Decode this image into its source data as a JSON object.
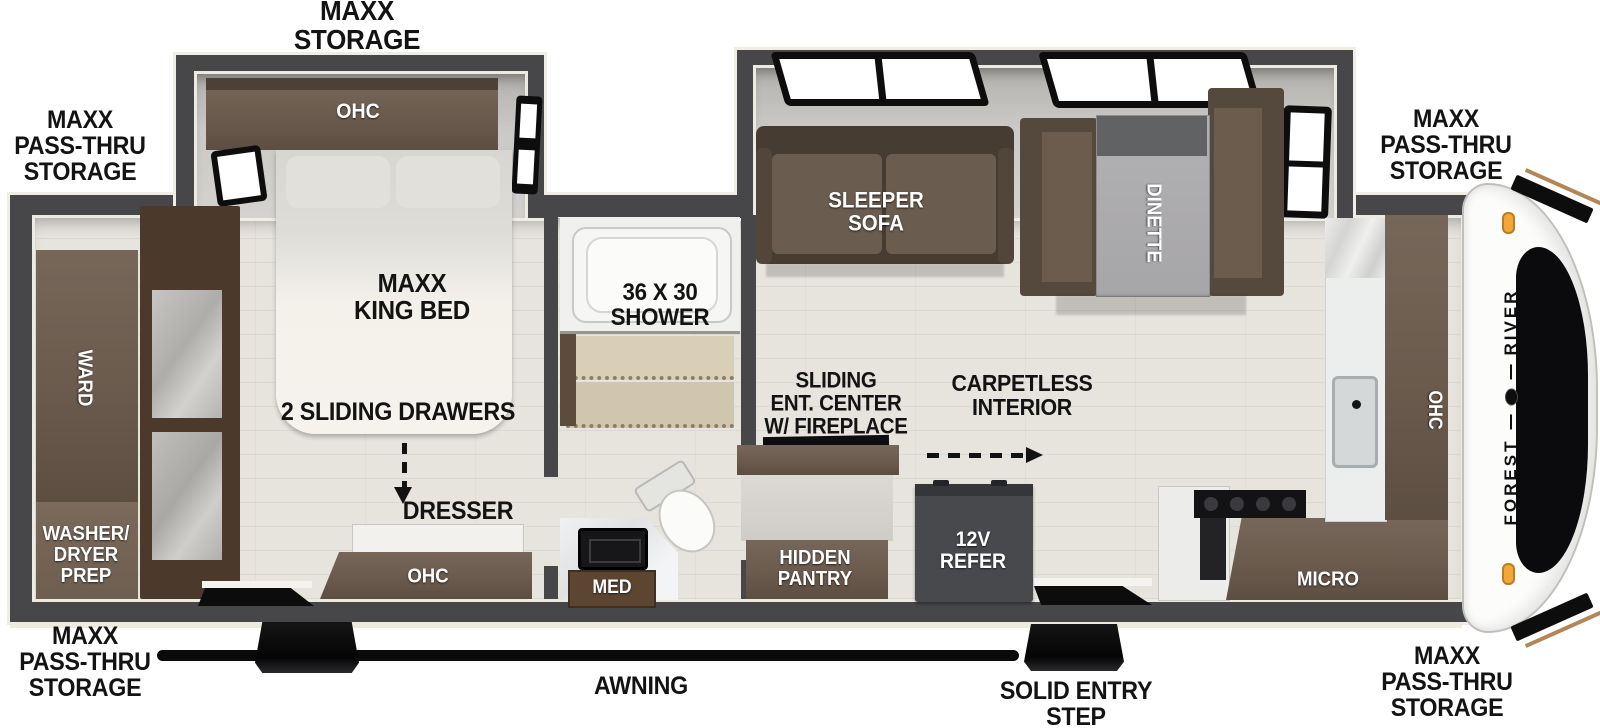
{
  "colors": {
    "wall": "#47474a",
    "trim": "#edeae2",
    "floor": "#e7e4de",
    "cabinet_brown": "#6b5b4e",
    "sofa_brown": "#5c4e41",
    "label_black": "#131313",
    "label_white": "#ffffff",
    "refer_gray": "#48494c",
    "accent_orange": "#f4a636"
  },
  "exterior": {
    "storage_top": "MAXX\nSTORAGE",
    "passthru": "MAXX\nPASS-THRU\nSTORAGE",
    "awning": "AWNING",
    "entry_step": "SOLID ENTRY\nSTEP"
  },
  "bedroom": {
    "ohc": "OHC",
    "bed": "MAXX\nKING BED",
    "drawers": "2 SLIDING DRAWERS",
    "dresser": "DRESSER",
    "dresser_ohc": "OHC",
    "ward": "WARD",
    "washer": "WASHER/\nDRYER\nPREP"
  },
  "bathroom": {
    "shower": "36 X 30\nSHOWER",
    "med": "MED"
  },
  "living": {
    "sofa": "SLEEPER\nSOFA",
    "dinette": "DINETTE",
    "ent_center": "SLIDING\nENT. CENTER\nW/ FIREPLACE",
    "carpetless": "CARPETLESS\nINTERIOR",
    "pantry": "HIDDEN\nPANTRY",
    "refer": "12V\nREFER"
  },
  "kitchen": {
    "micro": "MICRO",
    "ohc": "OHC"
  },
  "brand": {
    "first": "FOREST",
    "second": "RIVER"
  }
}
